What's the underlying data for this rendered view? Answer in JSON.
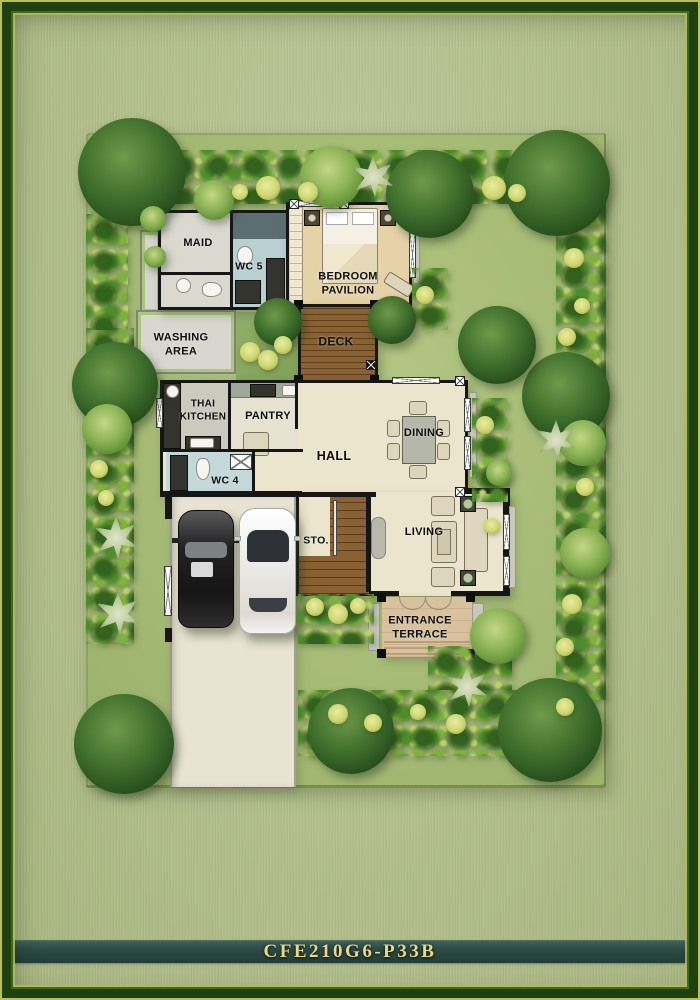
{
  "plate": {
    "code": "CFE210G6-P33B"
  },
  "plan": {
    "rooms": {
      "maid": {
        "lines": [
          "MAID"
        ]
      },
      "wc5": {
        "lines": [
          "WC 5"
        ]
      },
      "bedroom_pavilion": {
        "lines": [
          "BEDROOM",
          "PAVILION"
        ]
      },
      "washing_area": {
        "lines": [
          "WASHING",
          "AREA"
        ]
      },
      "deck": {
        "lines": [
          "DECK"
        ]
      },
      "thai_kitchen": {
        "lines": [
          "THAI",
          "KITCHEN"
        ]
      },
      "pantry": {
        "lines": [
          "PANTRY"
        ]
      },
      "hall": {
        "lines": [
          "HALL"
        ]
      },
      "dining": {
        "lines": [
          "DINING"
        ]
      },
      "wc4": {
        "lines": [
          "WC 4"
        ]
      },
      "storage": {
        "lines": [
          "STO."
        ]
      },
      "living": {
        "lines": [
          "LIVING"
        ]
      },
      "entrance_terrace": {
        "lines": [
          "ENTRANCE",
          "TERRACE"
        ]
      }
    }
  },
  "palette": {
    "frame_green": "#20400f",
    "background_sage": "#b3c08d",
    "lawn_green": "#a8bd78",
    "plate_band": "#2b4a43",
    "plate_text_gold": "#e7d88c",
    "deck_wood": "#8a6132",
    "hall_floor": "#ece5cd",
    "wall_black": "#161616"
  }
}
